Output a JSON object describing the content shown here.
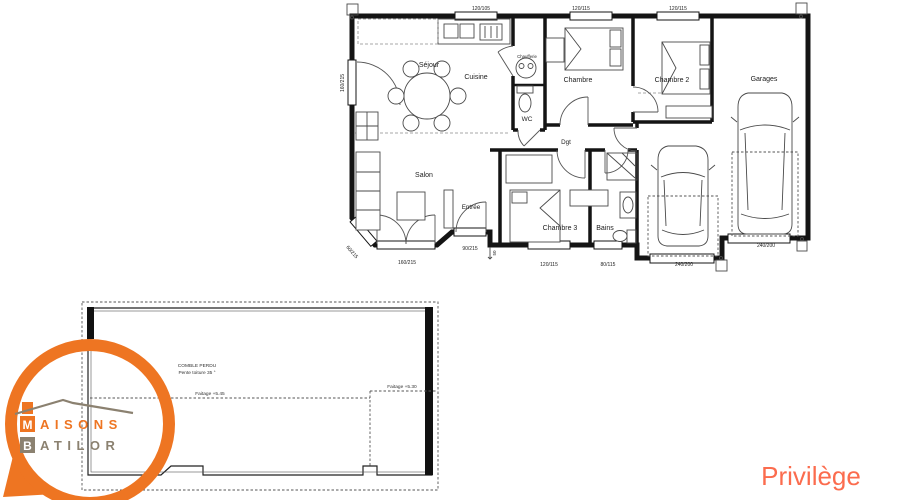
{
  "floor_plan": {
    "rooms": {
      "sejour": "Séjour",
      "cuisine": "Cuisine",
      "chaufferie": "Chaufferie",
      "wc": "WC",
      "chambre1": "Chambre",
      "chambre2": "Chambre 2",
      "garages": "Garages",
      "salon": "Salon",
      "entree": "Entrée",
      "chambre3": "Chambre 3",
      "bains": "Bains",
      "dgt": "Dgt"
    },
    "dims": {
      "top_cuisine": "120/105",
      "top_chambre1": "120/115",
      "top_chambre2": "120/115",
      "left_sejour": "160/215",
      "bay": "60/215",
      "bottom_salon": "160/215",
      "door_entree": "90/215",
      "step": "50",
      "bottom_chambre3": "120/115",
      "bottom_bains": "80/115",
      "garage_left": "240/200",
      "garage_right": "240/200"
    }
  },
  "attic_plan": {
    "title": "COMBLE PERDU",
    "subtitle": "Pente toiture 35 °",
    "ridge_left": "Faitage +5.45",
    "ridge_right": "Faitage +5.30"
  },
  "logo": {
    "word1_initial": "M",
    "word1_rest": "AISONS",
    "word2_initial": "B",
    "word2_rest": "ATILOR",
    "orange": "#EE7522",
    "taupe": "#8B8170"
  },
  "model": {
    "name": "Privilège",
    "color": "#FB6C4E"
  }
}
